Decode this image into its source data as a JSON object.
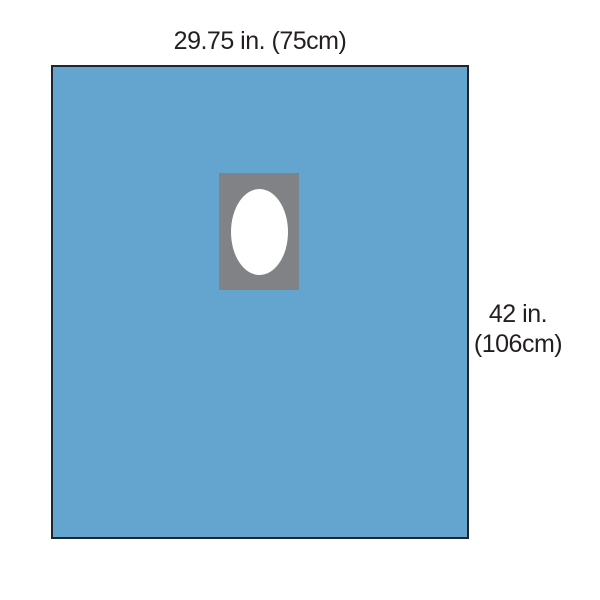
{
  "page": {
    "background": "#ffffff"
  },
  "diagram": {
    "top_label": "29.75 in. (75cm)",
    "side_label_line1": "42 in.",
    "side_label_line2": "(106cm)",
    "colors": {
      "drape": "#63a5ce",
      "drape_outline": "#20242c",
      "fenestration_patch": "#808285",
      "fenestration_opening": "#ffffff",
      "label_text": "#231f20"
    }
  }
}
